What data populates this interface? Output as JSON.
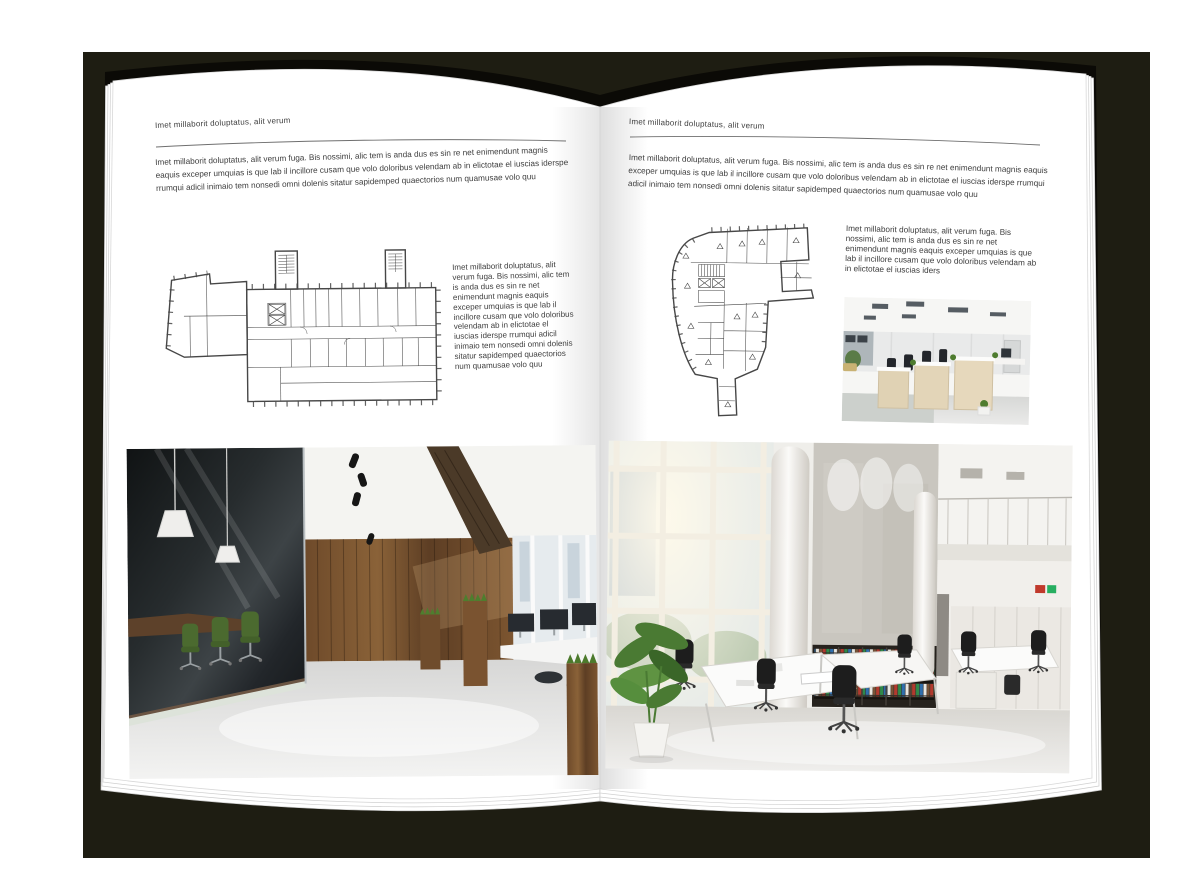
{
  "colors": {
    "backdrop": "#1e1d12",
    "cover": "#0b0a06",
    "page": "#ffffff",
    "text": "#3d3d3d",
    "rule_line": "#6f6f6f",
    "plan_line": "#474747"
  },
  "left_page": {
    "header": "Imet millaborit doluptatus, alit verum",
    "intro": "Imet millaborit doluptatus, alit verum fuga. Bis nossimi, alic tem is anda dus es sin re net enimendunt magnis eaquis exceper umquias is que lab il incillore cusam que volo doloribus velendam ab in elictotae el iuscias iderspe rrumqui adicil inimaio tem nonsedi omni dolenis sitatur sapidemped quaectorios num quamusae volo quu",
    "side_text": "Imet millaborit doluptatus, alit verum fuga. Bis nossimi, alic tem is anda dus es sin re net enimendunt magnis eaquis exceper umquias is que lab il incillore cusam que volo doloribus velendam ab in elictotae el iuscias iderspe rrumqui adicil inimaio tem nonsedi omni dolenis sitatur sapidemped quaectorios num quamusae volo quu"
  },
  "right_page": {
    "header": "Imet millaborit doluptatus, alit verum",
    "intro": "Imet millaborit doluptatus, alit verum fuga. Bis nossimi, alic tem is anda dus es sin re net enimendunt magnis eaquis exceper umquias is que lab il incillore cusam que volo doloribus velendam ab in elictotae el iuscias iderspe rrumqui adicil inimaio tem nonsedi omni dolenis sitatur sapidemped quaectorios num quamusae volo quu",
    "side_text": "Imet millaborit doluptatus, alit verum fuga. Bis nossimi, alic tem is anda dus es sin re net enimendunt magnis eaquis exceper umquias is que lab il incillore cusam que volo doloribus velendam ab in elictotae el iuscias iders"
  }
}
